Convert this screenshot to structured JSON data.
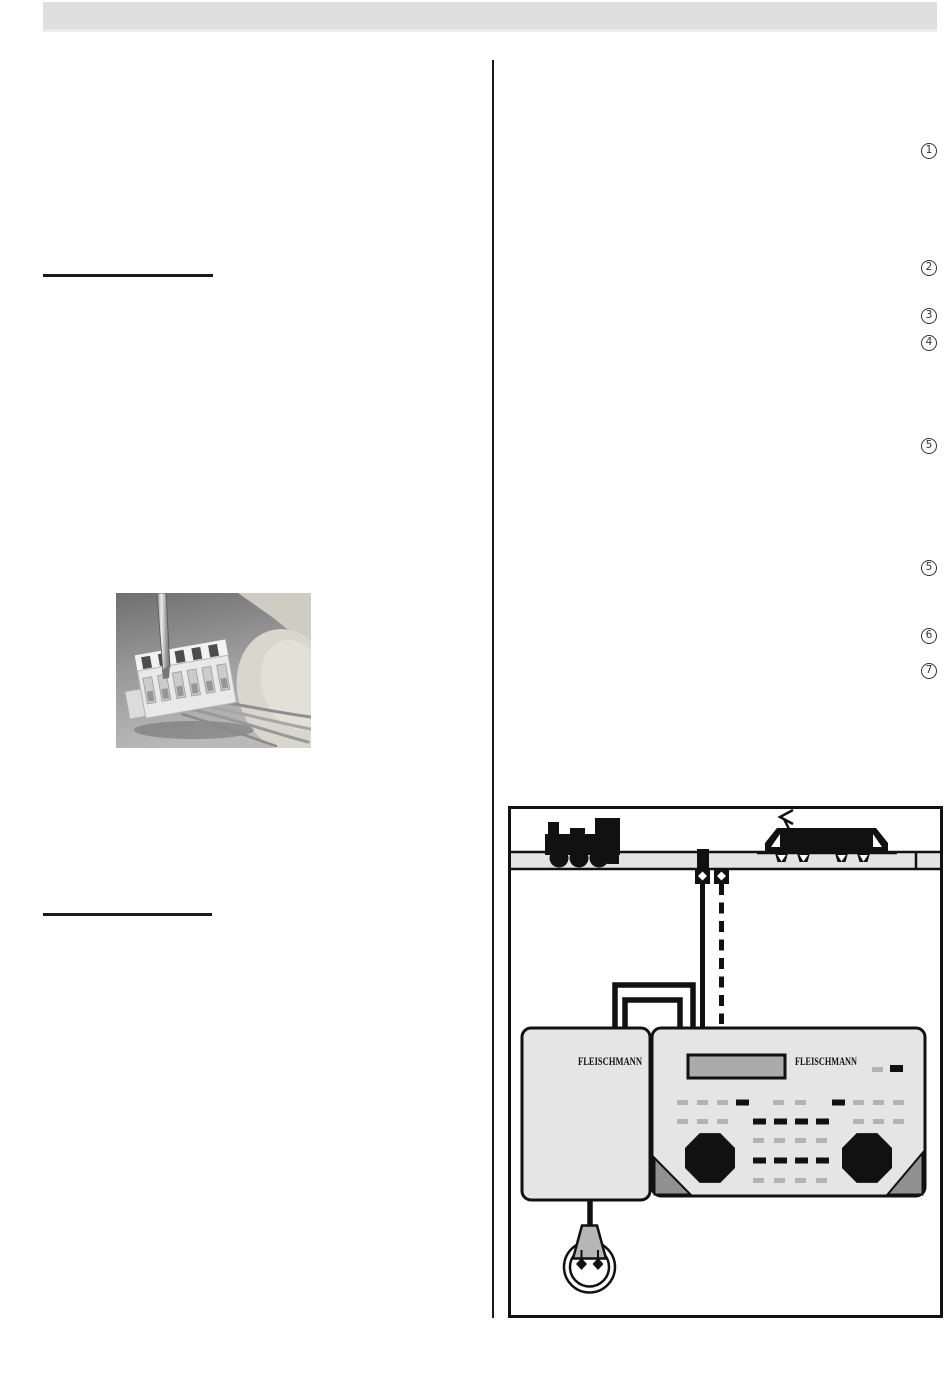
{
  "callouts": [
    "1",
    "2",
    "3",
    "4",
    "5",
    "5",
    "6",
    "7"
  ],
  "diagram": {
    "transformer_label": "FLEISCHMANN",
    "controller_label": "FLEISCHMANN"
  },
  "colors": {
    "header_bar": "#dfdfdf",
    "rule_line": "#1a1a1a",
    "track_fill": "#e3e3e3",
    "device_fill": "#e5e5e5",
    "display_fill": "#ababab",
    "button_light": "#b3b3b3",
    "button_dark": "#111111",
    "corner_accent": "#919191",
    "plug_fill": "#b6b6b6"
  }
}
